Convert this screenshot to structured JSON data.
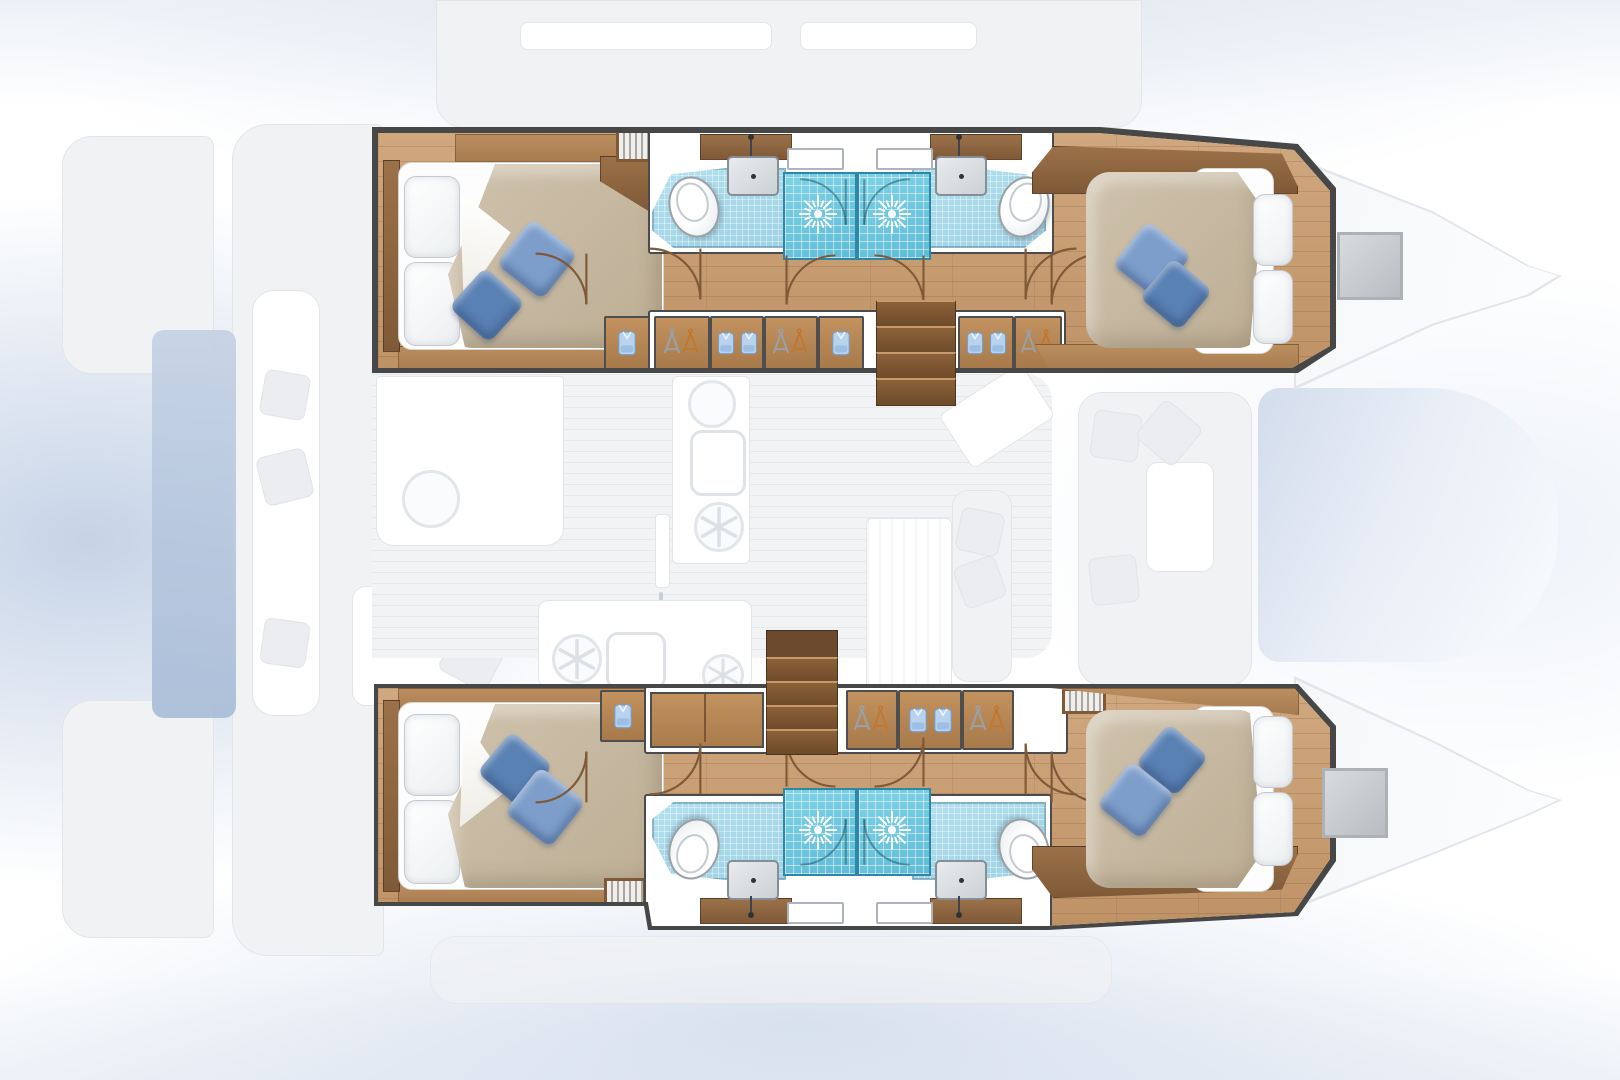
{
  "scene": {
    "type": "catamaran-floorplan-top-view",
    "hulls": 2,
    "cabins": 4,
    "bathrooms": 4,
    "orientation": "bow-right-stern-left"
  },
  "counts": {
    "double_beds": 4,
    "pillows": 8,
    "blue_cushions": 8,
    "showers": 4,
    "toilets": 4,
    "washbasins": 4,
    "wardrobe_units": 8,
    "companionway_stairs": 2,
    "vent_grilles": 5,
    "deck_hatches": 2,
    "windows": 4
  },
  "icons": [
    "shower-head-icon",
    "toilet-icon",
    "washbasin-icon",
    "faucet-icon",
    "hanger-pair-icon",
    "hanging-shirt-icon",
    "vent-grille-icon",
    "stairs-icon",
    "door-swing-icon",
    "fridge-snowflake-icon",
    "galley-sink-icon",
    "cutlery-icon",
    "sliding-door-arrow-icon"
  ],
  "palette": {
    "outline": "#474747",
    "wood1": "#d0a87f",
    "wood1b": "#bf9266",
    "woodDark": "#7f5a38",
    "trim": "#a87c50",
    "step": "#6d4a2a",
    "shower": "#5fbcd6",
    "showerEdge": "#2e87a6",
    "bath": "#9ed2e4",
    "duvet": "#bdae95",
    "cushLight": "#7d9ecb",
    "cushDark": "#5a81b4",
    "ghost": "#f1f2f4",
    "ghostLine": "#e2e5ea",
    "hangerGray": "#98a1aa",
    "hangerOrange": "#c2772e",
    "shirtFill": "#b9d3ee",
    "shirtEdge": "#7b9cc2"
  }
}
